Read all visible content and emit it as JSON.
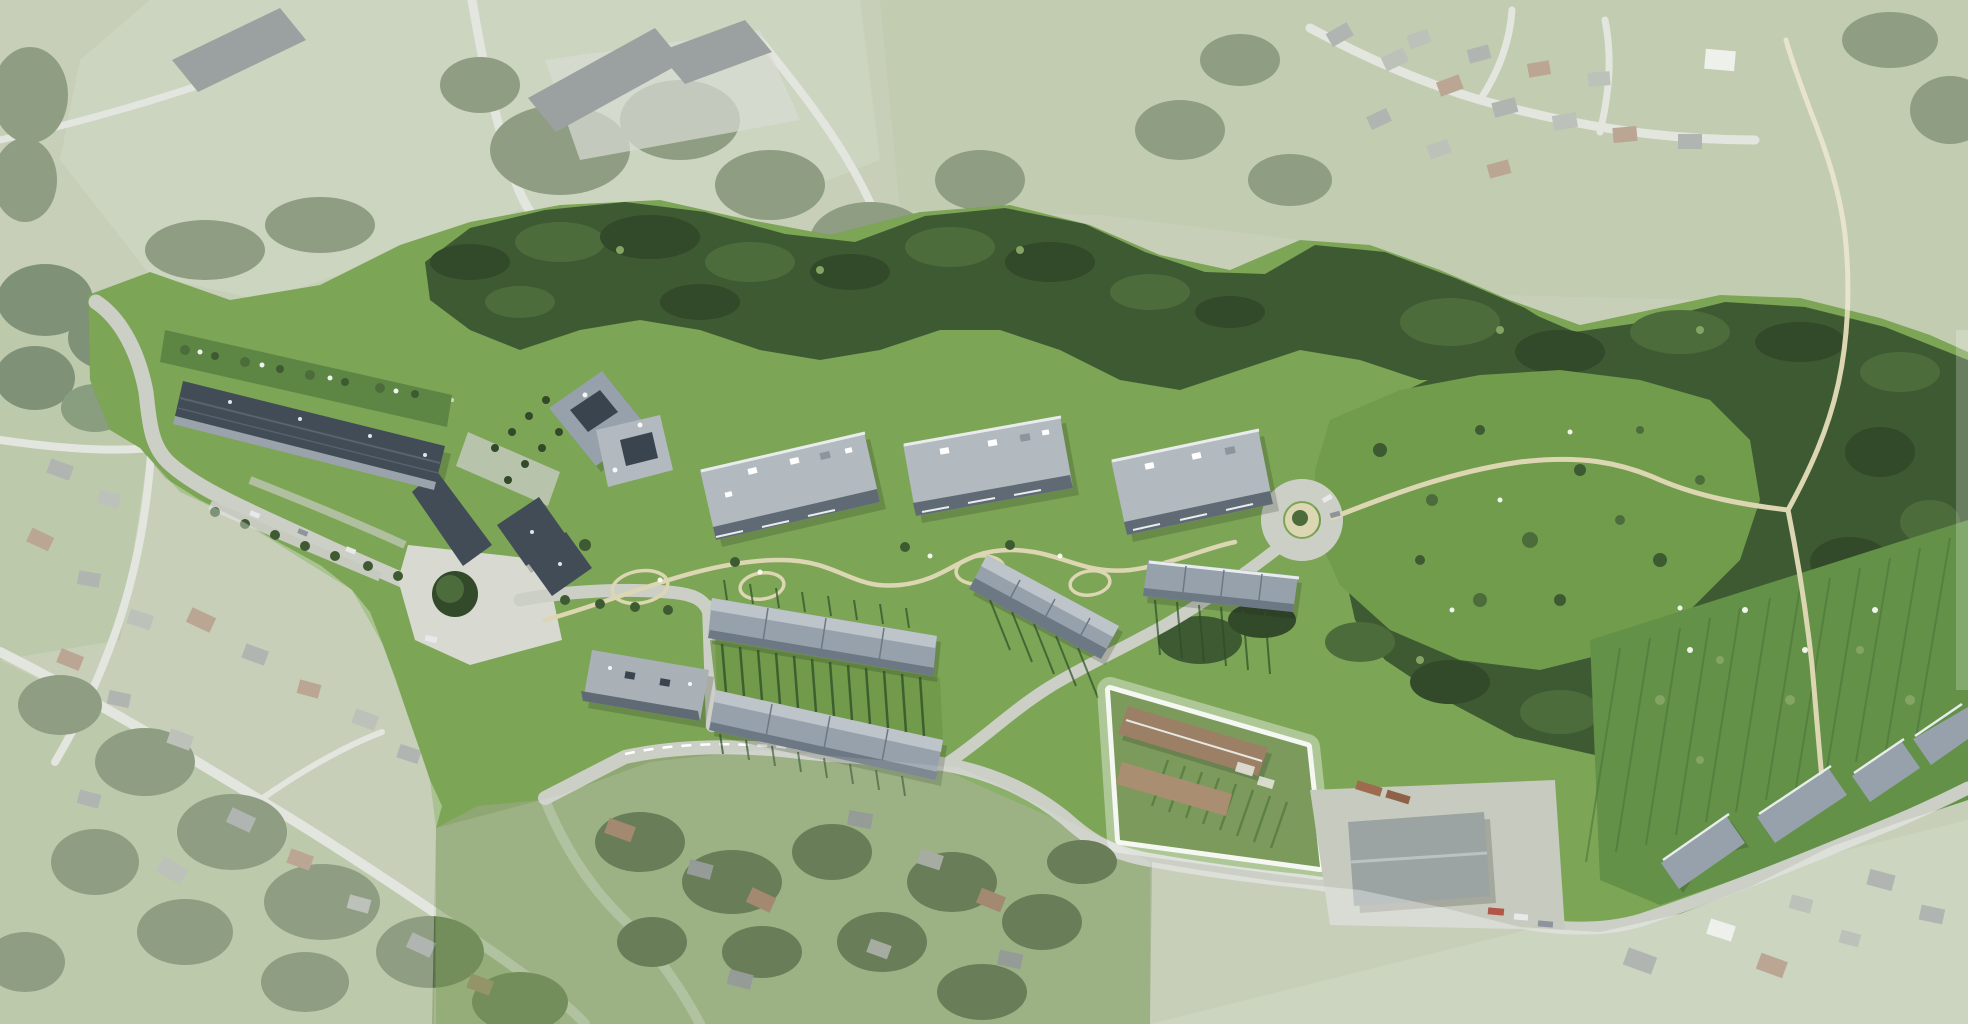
{
  "image": {
    "type": "aerial-site-plan-photomontage",
    "description": "Bird's-eye aerial photograph with a rendered residential master plan; the development site is shown in full colour while surrounding village, fields and farm context is faded with a white wash. No text, labels or UI controls are visible.",
    "width_px": 1968,
    "height_px": 1024
  },
  "palette": {
    "base": "#aab795",
    "field1": "#a3b287",
    "field2": "#b2bfa0",
    "field3": "#9cad80",
    "lawn": "#7ca556",
    "lawn2": "#6e9749",
    "meadow": "#719c4b",
    "woodDark": "#32492a",
    "wood": "#3e5a33",
    "woodLight": "#4d6c3c",
    "treeHi": "#84a463",
    "hedge": "#2e4d28",
    "villTree": "#556c42",
    "allot": "#629147",
    "allotRow": "#4d7539",
    "roofGarden": "#5d8644",
    "roadLight": "#d5d8cf",
    "roadSite": "#cbcfc6",
    "pathBeige": "#dcd6b2",
    "plaza": "#d8d9d1",
    "slateRoof": "#414c57",
    "slateRidge": "#5a646e",
    "facadeLight": "#9aa3ab",
    "blockRoof": "#b2b9bf",
    "blockParapet": "#e9eced",
    "blockFacade": "#5f6a74",
    "glassDark": "#39444f",
    "rowRoof": "#96a1ab",
    "rowRoofLight": "#bdc4ca",
    "rowFace": "#6c7883",
    "barRoof": "#a9b1b7",
    "farmRoof1": "#9b8066",
    "farmRoof2": "#a98e71",
    "cropGreen": "#7d9a5d",
    "warehouseRoof": "#9ba4a3",
    "warehouseRidge": "#bcc2c0",
    "yard": "#c6cabf",
    "villRoof1": "#878f89",
    "villRoof2": "#9aa196",
    "villRoofBrown": "#96795c",
    "villRoofWhite": "#e6e8e1",
    "barnRoof": "#68716f",
    "shadow": "#1c2418",
    "white": "#ffffff",
    "carLight": "#e7e9ea",
    "carDark": "#8d949b",
    "fadeWhite": "#ffffff"
  },
  "features": {
    "site": "New residential quarter (full-colour photomontage)",
    "linear_building": "Long bent apartment building with roof-garden terrace, west end of site",
    "point_building": "Angular twin-volume apartment house",
    "blocks": [
      "Apartment block 1",
      "Apartment block 2",
      "Apartment block 3"
    ],
    "bar_building": "Small apartment bar south of the square",
    "square": "Paved neighbourhood square with single large tree",
    "row_houses": "Arcing chain of terraced houses with private garden strips",
    "cul_de_sac": "Circular turning head at east end of access loop",
    "retained_plot": "White-highlighted retained farmstead / market-garden plot",
    "warehouse": "Existing agricultural hall with paved yard",
    "woodland": "Dark tree belt and large wooded meadow with scattered trees",
    "allotments": "Orchard / allotment strips with terraced houses along lower road",
    "footpaths": "Beige walking paths through gardens and meadow",
    "context": "Existing village, farm and fields shown faded (white wash)"
  },
  "fade": {
    "outer_opacity": 0.34,
    "inner_south_opacity": 0.12
  }
}
